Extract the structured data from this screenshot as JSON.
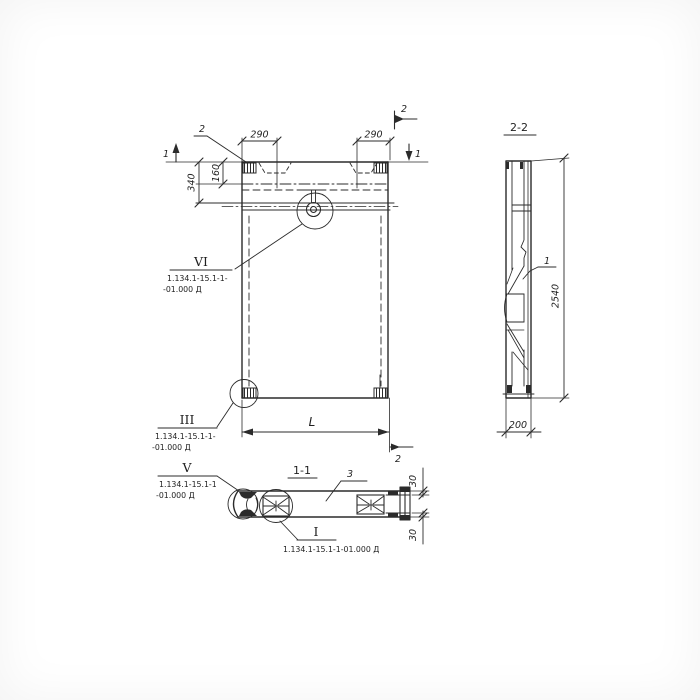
{
  "meta": {
    "description": "Hand-drawn structural panel working drawing with sections"
  },
  "colors": {
    "ink": "#2b2b2b",
    "paper": "#ffffff"
  },
  "elevation": {
    "callout_top": "2",
    "cut_mark_left": "1",
    "cut_mark_right": "1",
    "cut_mark_top_right": "2",
    "cut_mark_bottom": "2",
    "dim_290_left": "290",
    "dim_290_right": "290",
    "dim_340": "340",
    "dim_160": "160",
    "dim_length": "L",
    "detail_vi_label": "VI",
    "detail_vi_ref1": "1.134.1-15.1-1-",
    "detail_vi_ref2": "-01.000 Д",
    "detail_iii_label": "III",
    "detail_iii_ref1": "1.134.1-15.1-1-",
    "detail_iii_ref2": "-01.000 Д"
  },
  "section_2_2": {
    "title": "2-2",
    "part_label": "1",
    "dim_height": "2540",
    "dim_width": "200"
  },
  "section_1_1": {
    "title": "1-1",
    "part_label": "3",
    "dim_30_top": "30",
    "dim_30_bottom": "30",
    "detail_v_label": "V",
    "detail_v_ref1": "1.134.1-15.1-1",
    "detail_v_ref2": "-01.000 Д",
    "detail_i_label": "I",
    "detail_i_ref": "1.134.1-15.1-1-01.000 Д"
  }
}
